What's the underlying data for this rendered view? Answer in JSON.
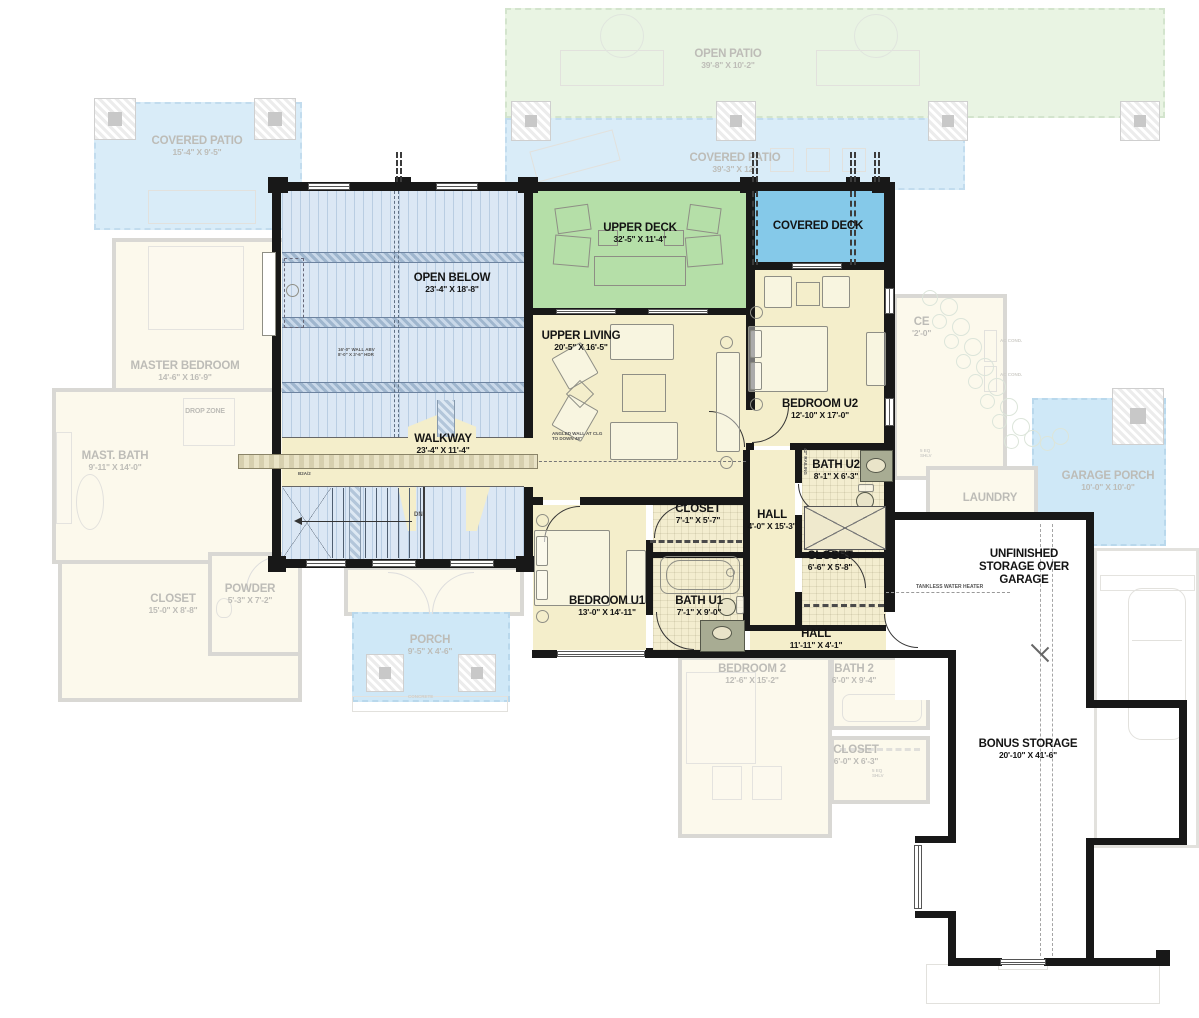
{
  "colors": {
    "wall": "#181818",
    "room_yellow": "#f4eecb",
    "deck_green": "#b5dfa8",
    "deck_blue": "#85c9e9",
    "open_below_blue": "#dbe7f4",
    "faded_gray": "#d9d8d4",
    "faded_patio_green": "#e9f4e3",
    "faded_patio_blue": "#d9ecf8"
  },
  "rooms": {
    "open_below": {
      "name": "OPEN BELOW",
      "dims": "23'-4\" X 18'-8\""
    },
    "upper_deck": {
      "name": "UPPER DECK",
      "dims": "32'-5\" X 11'-4\""
    },
    "covered_deck": {
      "name": "COVERED DECK"
    },
    "upper_living": {
      "name": "UPPER LIVING",
      "dims": "20'-5\" X 16'-5\""
    },
    "walkway": {
      "name": "WALKWAY",
      "dims": "23'-4\" X 11'-4\""
    },
    "bedroom_u2": {
      "name": "BEDROOM U2",
      "dims": "12'-10\" X 17'-0\""
    },
    "bath_u2": {
      "name": "BATH U2",
      "dims": "8'-1\" X 6'-3\""
    },
    "closet_u1": {
      "name": "CLOSET",
      "dims": "7'-1\" X 5'-7\""
    },
    "hall_upper": {
      "name": "HALL",
      "dims": "4'-0\" X 15'-3\""
    },
    "closet_u2": {
      "name": "CLOSET",
      "dims": "6'-6\" X 5'-8\""
    },
    "bedroom_u1": {
      "name": "BEDROOM U1",
      "dims": "13'-0\" X 14'-11\""
    },
    "bath_u1": {
      "name": "BATH U1",
      "dims": "7'-1\" X 9'-0\""
    },
    "hall_lower": {
      "name": "HALL",
      "dims": "11'-11\" X 4'-1\""
    },
    "unfinished_storage": {
      "name": "UNFINISHED STORAGE OVER GARAGE"
    },
    "bonus_storage": {
      "name": "BONUS STORAGE",
      "dims": "20'-10\" X 41'-6\""
    }
  },
  "faded_rooms": {
    "open_patio": {
      "name": "OPEN PATIO",
      "dims": "39'-8\" X 10'-2\""
    },
    "covered_patio_rear": {
      "name": "COVERED PATIO",
      "dims": "39'-3\" X 12'-"
    },
    "covered_patio_left": {
      "name": "COVERED PATIO",
      "dims": "15'-4\" X 9'-5\""
    },
    "master_bedroom": {
      "name": "MASTER BEDROOM",
      "dims": "14'-6\" X 16'-9\""
    },
    "mast_bath": {
      "name": "MAST. BATH",
      "dims": "9'-11\" X 14'-0\""
    },
    "drop_zone": {
      "name": "DROP ZONE"
    },
    "powder": {
      "name": "POWDER",
      "dims": "5'-3\" X 7'-2\""
    },
    "master_closet": {
      "name": "CLOSET",
      "dims": "15'-0\" X 8'-8\""
    },
    "porch": {
      "name": "PORCH",
      "dims": "9'-5\" X 4'-6\""
    },
    "bedroom_2": {
      "name": "BEDROOM 2",
      "dims": "12'-6\" X 15'-2\""
    },
    "bath_2": {
      "name": "BATH 2",
      "dims": "6'-0\" X 9'-4\""
    },
    "closet_2": {
      "name": "CLOSET",
      "dims": "6'-0\" X 6'-3\""
    },
    "laundry": {
      "name": "LAUNDRY"
    },
    "garage_porch": {
      "name": "GARAGE PORCH",
      "dims": "10'-0\" X 10'-0\""
    },
    "office_partial": {
      "name": "CE",
      "dims": "'2'-0\""
    }
  },
  "notes": {
    "tankless": "TANKLESS WATER HEATER",
    "dn": "DN",
    "beam": "B2A/2",
    "rail": "42\" RAILING",
    "open_below_note": "16'-0\" WALL ABV\n8'-0\" X 3'-6\" HDR",
    "living_note": "ANGLED WALL AT CLG\nTO DOWN 48\"",
    "ac": "AC COND.",
    "shelves": "5 EQ SHLV",
    "concrete": "CONCRETE"
  }
}
